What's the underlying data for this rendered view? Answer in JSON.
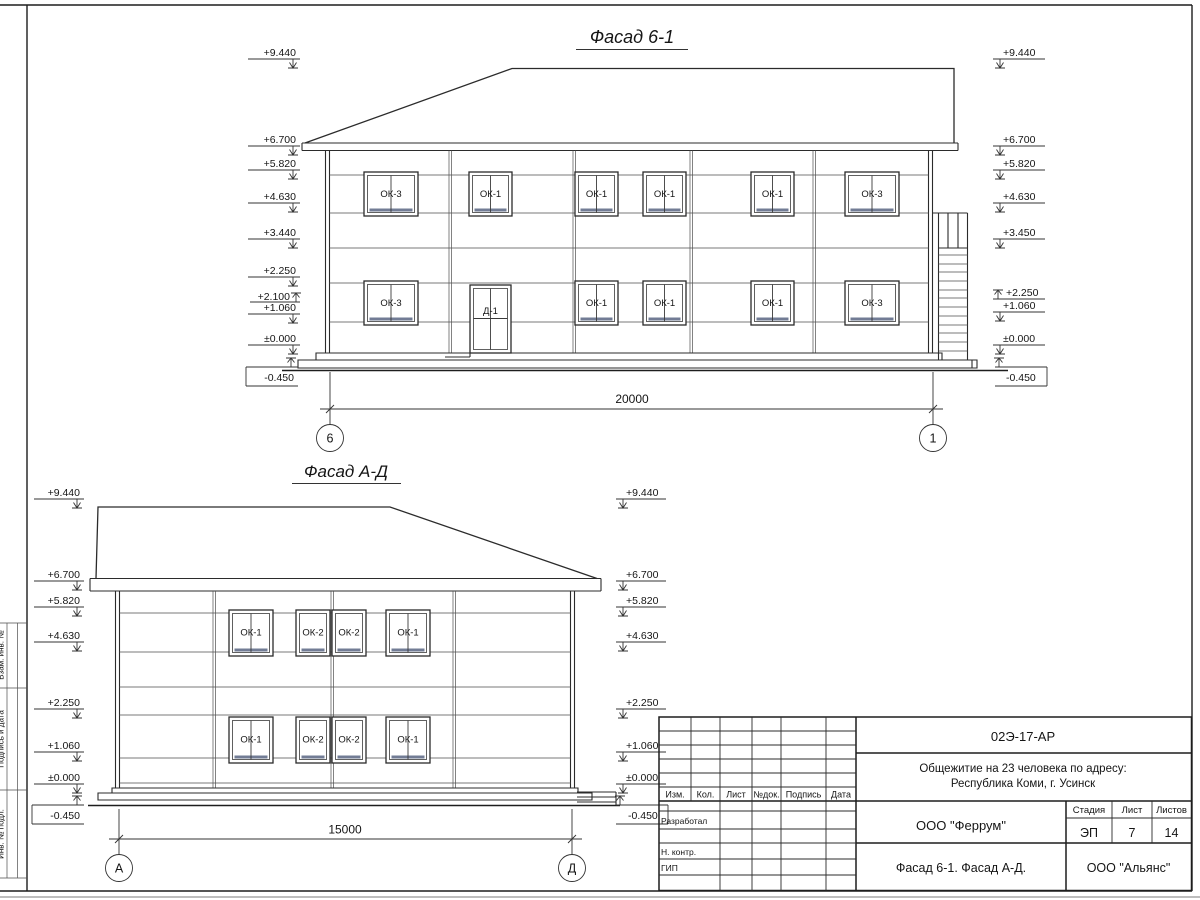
{
  "sheet": {
    "doc_number": "02Э-17-АР",
    "project_title_line1": "Общежитие на 23 человека по адресу:",
    "project_title_line2": "Республика Коми, г. Усинск",
    "header_cols": [
      "Изм.",
      "Кол.",
      "Лист",
      "№док.",
      "Подпись",
      "Дата"
    ],
    "roles": [
      "Разработал",
      "Н. контр.",
      "ГИП"
    ],
    "org_designer": "ООО \"Феррум\"",
    "org_customer": "ООО \"Альянс\"",
    "stage_label": "Стадия",
    "sheet_label": "Лист",
    "sheets_label": "Листов",
    "stage": "ЭП",
    "sheet_no": "7",
    "sheets_total": "14",
    "drawing_caption": "Фасад 6-1. Фасад А-Д.",
    "margin_labels": [
      "Взам. инв. №",
      "Подпись и дата",
      "Инв. № подл."
    ]
  },
  "facade1": {
    "title": "Фасад 6-1",
    "dimension": "20000",
    "axis_left": "6",
    "axis_right": "1",
    "left_marks": [
      "+9.440",
      "+6.700",
      "+5.820",
      "+4.630",
      "+3.440",
      "+2.250",
      "+2.100",
      "+1.060",
      "±0.000",
      "-0.450"
    ],
    "right_marks": [
      "+9.440",
      "+6.700",
      "+5.820",
      "+4.630",
      "+3.450",
      "+2.250",
      "+1.060",
      "±0.000",
      "-0.450"
    ],
    "windows_upper": [
      "ОК-3",
      "ОК-1",
      "ОК-1",
      "ОК-1",
      "ОК-1",
      "ОК-3"
    ],
    "windows_lower": [
      "ОК-3",
      "Д-1",
      "ОК-1",
      "ОК-1",
      "ОК-1",
      "ОК-3"
    ]
  },
  "facade2": {
    "title": "Фасад А-Д",
    "dimension": "15000",
    "axis_left": "А",
    "axis_right": "Д",
    "left_marks": [
      "+9.440",
      "+6.700",
      "+5.820",
      "+4.630",
      "+2.250",
      "+1.060",
      "±0.000",
      "-0.450"
    ],
    "right_marks": [
      "+9.440",
      "+6.700",
      "+5.820",
      "+4.630",
      "+2.250",
      "+1.060",
      "±0.000",
      "-0.450"
    ],
    "windows_upper": [
      "ОК-1",
      "ОК-2",
      "ОК-2",
      "ОК-1"
    ],
    "windows_lower": [
      "ОК-1",
      "ОК-2",
      "ОК-2",
      "ОК-1"
    ]
  },
  "colors": {
    "line": "#2b2b2b",
    "window_sill": "#727c95",
    "paper": "#ffffff"
  }
}
